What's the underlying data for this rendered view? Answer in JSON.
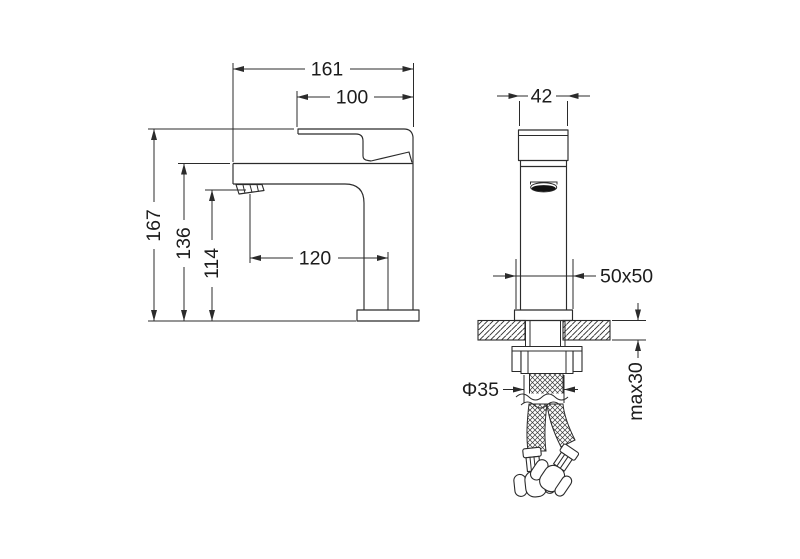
{
  "labels": {
    "d161": "161",
    "d100": "100",
    "d42": "42",
    "d167": "167",
    "d136": "136",
    "d114": "114",
    "d120": "120",
    "d50x50": "50x50",
    "dphi35": "Φ35",
    "dmax30": "max30"
  },
  "dimensions": [
    {
      "id": "d161",
      "label": "161",
      "view": "side",
      "axis": "horizontal"
    },
    {
      "id": "d100",
      "label": "100",
      "view": "side",
      "axis": "horizontal"
    },
    {
      "id": "d167",
      "label": "167",
      "view": "side",
      "axis": "vertical"
    },
    {
      "id": "d136",
      "label": "136",
      "view": "side",
      "axis": "vertical"
    },
    {
      "id": "d114",
      "label": "114",
      "view": "side",
      "axis": "vertical"
    },
    {
      "id": "d120",
      "label": "120",
      "view": "side",
      "axis": "horizontal"
    },
    {
      "id": "d42",
      "label": "42",
      "view": "front",
      "axis": "horizontal"
    },
    {
      "id": "d50x50",
      "label": "50x50",
      "view": "front",
      "axis": "horizontal"
    },
    {
      "id": "dphi35",
      "label": "Φ35",
      "view": "front",
      "axis": "horizontal"
    },
    {
      "id": "dmax30",
      "label": "max30",
      "view": "front",
      "axis": "vertical"
    }
  ],
  "colors": {
    "line": "#2b2b2b",
    "text": "#1c1c1c",
    "background": "#ffffff",
    "outlet_fill": "#121212"
  }
}
